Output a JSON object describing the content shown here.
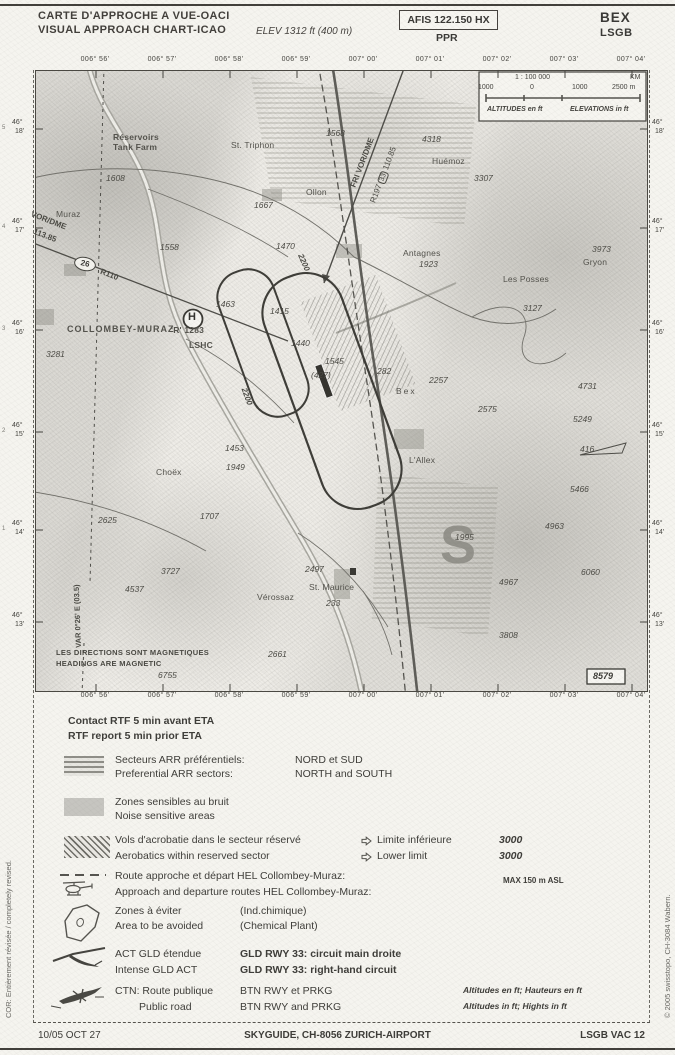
{
  "header": {
    "title_line1": "CARTE D'APPROCHE A VUE-OACI",
    "title_line2": "VISUAL APPROACH CHART-ICAO",
    "elevation": "ELEV 1312 ft (400 m)",
    "afis": "AFIS 122.150 HX",
    "ppr": "PPR",
    "airport_name": "BEX",
    "airport_code": "LSGB"
  },
  "map": {
    "lon_labels": [
      "006° 56'",
      "006° 57'",
      "006° 58'",
      "006° 59'",
      "007° 00'",
      "007° 01'",
      "007° 02'",
      "007° 03'",
      "007° 04'"
    ],
    "lon_x": [
      95,
      162,
      229,
      296,
      363,
      430,
      497,
      564,
      631
    ],
    "lat_labels": [
      {
        "i": "5",
        "d": "46°",
        "m": "18'"
      },
      {
        "i": "4",
        "d": "46°",
        "m": "17'"
      },
      {
        "i": "3",
        "d": "46°",
        "m": "16'"
      },
      {
        "i": "2",
        "d": "46°",
        "m": "15'"
      },
      {
        "i": "1",
        "d": "46°",
        "m": "14'"
      },
      {
        "i": "",
        "d": "46°",
        "m": "13'"
      }
    ],
    "lat_y": [
      128,
      227,
      329,
      431,
      529,
      621
    ],
    "scale_box": {
      "ratio": "1 : 100 000",
      "unit": "KM",
      "tick1": "1000",
      "tick2": "0",
      "tick3": "1000",
      "tick4": "2500 m",
      "altitudes": "ALTITUDES en ft",
      "elevations": "ELEVATIONS in ft"
    },
    "fri_vor": {
      "name": "FRI VOR/DME",
      "radial": "R197",
      "rwy_badge": "33",
      "freq": "110.85"
    },
    "left_vor": {
      "name": "VOR/DME",
      "freq": "113.85",
      "distance_badge": "26",
      "radial": "R110"
    },
    "heliport": {
      "symbol": "H"
    },
    "circuit_altitude": "2200",
    "sector_letter_south": "S",
    "variation": "VAR 0°26' E (03.5)",
    "magnetic_fr": "LES DIRECTIONS SONT MAGNETIQUES",
    "magnetic_en": "HEADINGS ARE MAGNETIC",
    "boxed_elevation": "8579",
    "towns": [
      {
        "t": "Réservoirs",
        "x": 113,
        "y": 132,
        "b": 1
      },
      {
        "t": "Tank Farm",
        "x": 113,
        "y": 142,
        "b": 1
      },
      {
        "t": "St. Triphon",
        "x": 231,
        "y": 140
      },
      {
        "t": "Ollon",
        "x": 306,
        "y": 187
      },
      {
        "t": "Muraz",
        "x": 56,
        "y": 209
      },
      {
        "t": "Huémoz",
        "x": 432,
        "y": 156
      },
      {
        "t": "Antagnes",
        "x": 403,
        "y": 248
      },
      {
        "t": "Les Posses",
        "x": 503,
        "y": 274
      },
      {
        "t": "Bex",
        "x": 396,
        "y": 386,
        "ls": 2
      },
      {
        "t": "L'Allex",
        "x": 409,
        "y": 455
      },
      {
        "t": "Choëx",
        "x": 156,
        "y": 467
      },
      {
        "t": "St. Maurice",
        "x": 309,
        "y": 582
      },
      {
        "t": "Vérossaz",
        "x": 257,
        "y": 592
      },
      {
        "t": "Gryon",
        "x": 583,
        "y": 257
      },
      {
        "t": "COLLOMBEY-MURAZ",
        "x": 67,
        "y": 324,
        "b": 1,
        "ls": 1,
        "fs": 9
      },
      {
        "t": "'R' 1283",
        "x": 171,
        "y": 325,
        "b": 1
      },
      {
        "t": "LSHC",
        "x": 189,
        "y": 340,
        "b": 1
      }
    ],
    "spots": [
      {
        "v": "1568",
        "x": 326,
        "y": 128
      },
      {
        "v": "1608",
        "x": 106,
        "y": 173
      },
      {
        "v": "1667",
        "x": 254,
        "y": 200
      },
      {
        "v": "4318",
        "x": 422,
        "y": 134
      },
      {
        "v": "3307",
        "x": 474,
        "y": 173
      },
      {
        "v": "3973",
        "x": 592,
        "y": 244
      },
      {
        "v": "1923",
        "x": 419,
        "y": 259
      },
      {
        "v": "1470",
        "x": 276,
        "y": 241
      },
      {
        "v": "1558",
        "x": 160,
        "y": 242
      },
      {
        "v": "1463",
        "x": 216,
        "y": 299
      },
      {
        "v": "1415",
        "x": 270,
        "y": 306
      },
      {
        "v": "1440",
        "x": 291,
        "y": 338
      },
      {
        "v": "1545",
        "x": 325,
        "y": 356
      },
      {
        "v": "(427)",
        "x": 311,
        "y": 370
      },
      {
        "v": "282",
        "x": 377,
        "y": 366
      },
      {
        "v": "2257",
        "x": 429,
        "y": 375
      },
      {
        "v": "2575",
        "x": 478,
        "y": 404
      },
      {
        "v": "4731",
        "x": 578,
        "y": 381
      },
      {
        "v": "5249",
        "x": 573,
        "y": 414
      },
      {
        "v": "416",
        "x": 580,
        "y": 444
      },
      {
        "v": "5466",
        "x": 570,
        "y": 484
      },
      {
        "v": "3127",
        "x": 523,
        "y": 303
      },
      {
        "v": "3281",
        "x": 46,
        "y": 349
      },
      {
        "v": "1453",
        "x": 225,
        "y": 443
      },
      {
        "v": "1949",
        "x": 226,
        "y": 462
      },
      {
        "v": "2625",
        "x": 98,
        "y": 515
      },
      {
        "v": "1707",
        "x": 200,
        "y": 511
      },
      {
        "v": "3727",
        "x": 161,
        "y": 566
      },
      {
        "v": "4537",
        "x": 125,
        "y": 584
      },
      {
        "v": "2497",
        "x": 305,
        "y": 564
      },
      {
        "v": "233",
        "x": 326,
        "y": 598
      },
      {
        "v": "2661",
        "x": 268,
        "y": 649
      },
      {
        "v": "6755",
        "x": 158,
        "y": 670
      },
      {
        "v": "1995",
        "x": 455,
        "y": 532
      },
      {
        "v": "4963",
        "x": 545,
        "y": 521
      },
      {
        "v": "4967",
        "x": 499,
        "y": 577
      },
      {
        "v": "6060",
        "x": 581,
        "y": 567
      },
      {
        "v": "3808",
        "x": 499,
        "y": 630
      }
    ]
  },
  "legend": {
    "contact_fr": "Contact RTF 5 min avant ETA",
    "contact_en": "RTF report 5 min prior ETA",
    "arr_fr": "Secteurs ARR préférentiels:",
    "arr_en": "Preferential ARR sectors:",
    "arr_val_fr": "NORD et SUD",
    "arr_val_en": "NORTH and SOUTH",
    "noise_fr": "Zones sensibles au bruit",
    "noise_en": "Noise sensitive areas",
    "acro_fr": "Vols d'acrobatie dans le secteur réservé",
    "acro_en": "Aerobatics within reserved sector",
    "acro_lim_fr": "Limite inférieure",
    "acro_lim_en": "Lower limit",
    "acro_val": "3000",
    "hel_fr": "Route approche et départ HEL Collombey-Muraz:",
    "hel_en": "Approach and departure routes HEL Collombey-Muraz:",
    "hel_note": "MAX 150 m ASL",
    "avoid_fr": "Zones à éviter",
    "avoid_en": "Area to be avoided",
    "avoid_val_fr": "(Ind.chimique)",
    "avoid_val_en": "(Chemical Plant)",
    "gld_fr": "ACT GLD étendue",
    "gld_en": "Intense GLD ACT",
    "gld_val_fr": "GLD RWY 33: circuit main droite",
    "gld_val_en": "GLD RWY 33: right-hand circuit",
    "ctn_fr": "CTN: Route publique",
    "ctn_en": "Public road",
    "ctn_val_fr": "BTN RWY et PRKG",
    "ctn_val_en": "BTN RWY and PRKG",
    "units_fr": "Altitudes en ft; Hauteurs en ft",
    "units_en": "Altitudes in ft; Hights in ft"
  },
  "footer": {
    "date": "10/05 OCT 27",
    "publisher": "SKYGUIDE, CH-8056 ZURICH-AIRPORT",
    "chart_ref": "LSGB VAC 12"
  },
  "margins": {
    "left_note": "COR: Entièrement révisée / completely revised.",
    "right_note": "© 2005 swisstopo, CH-3084 Wabern."
  }
}
